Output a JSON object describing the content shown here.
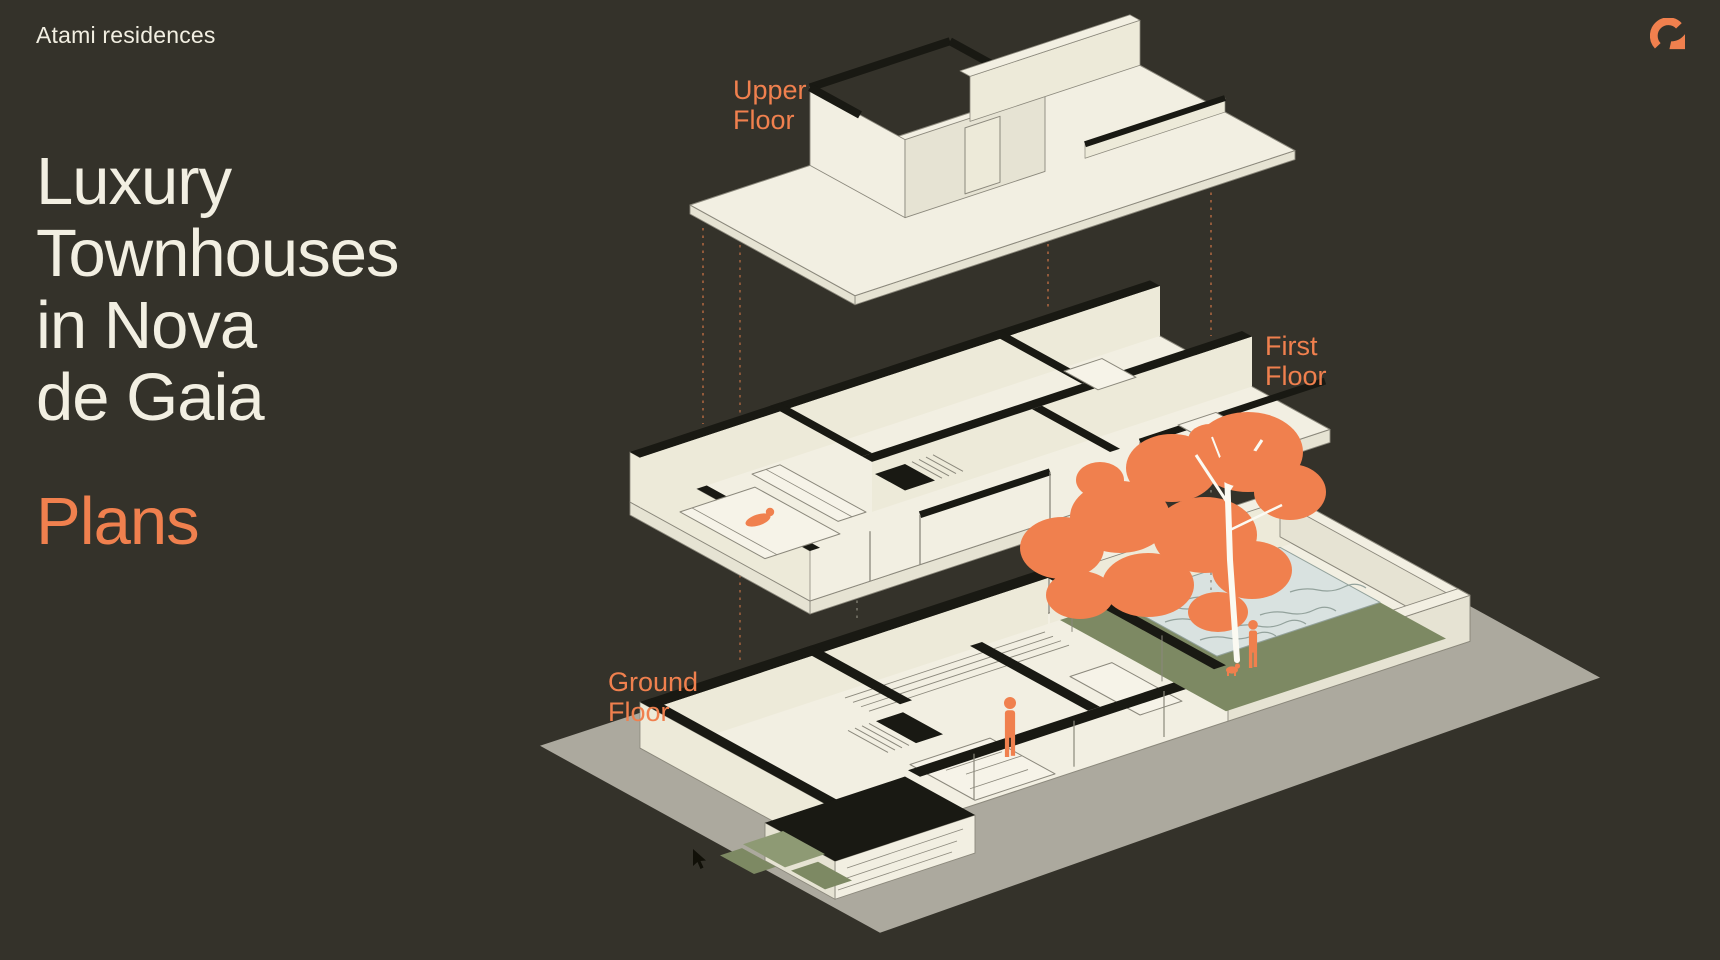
{
  "brand": {
    "name": "Atami residences",
    "logo_icon": "arc-mark-logo-icon"
  },
  "hero": {
    "title_lines": [
      "Luxury",
      "Townhouses",
      "in Nova",
      "de Gaia"
    ],
    "subtitle": "Plans"
  },
  "diagram": {
    "floors": [
      {
        "id": "upper",
        "label_line1": "Upper",
        "label_line2": "Floor"
      },
      {
        "id": "first",
        "label_line1": "First",
        "label_line2": "Floor"
      },
      {
        "id": "ground",
        "label_line1": "Ground",
        "label_line2": "Floor"
      }
    ]
  },
  "colors": {
    "background": "#34322a",
    "cream": "#f2efe2",
    "cream_shade": "#e6e3d3",
    "cream_inner": "#edead,9",
    "ink": "#191913",
    "orange": "#f0804e",
    "lawn": "#7d8963",
    "lawn_light": "#8e9a74",
    "pool": "#d9e2e0",
    "pool_line": "#93a29c",
    "base_grey": "#aca99e",
    "outline": "#8b887c",
    "dash_orange": "#aa6540",
    "dash_grey": "#8b887c",
    "trunk_white": "#fbfaf2"
  }
}
